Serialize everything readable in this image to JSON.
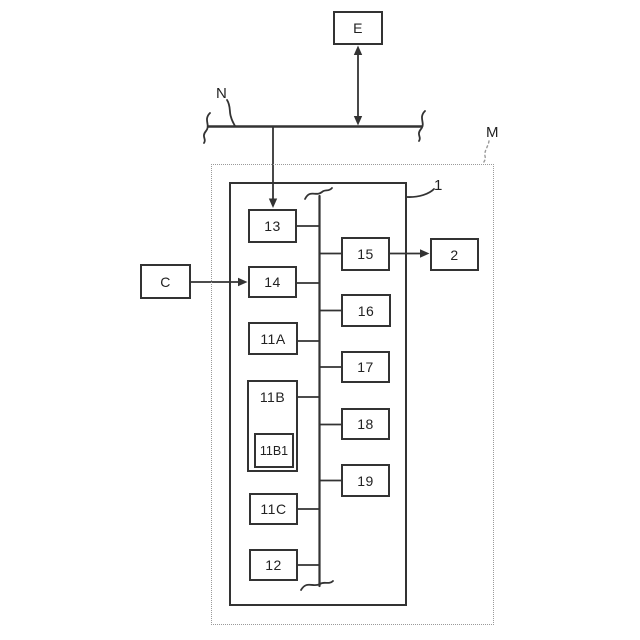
{
  "figure": {
    "type": "patent-block-diagram",
    "colors": {
      "line": "#333333",
      "boundary_dotted": "#9a9a9a",
      "background": "#ffffff",
      "text": "#222222"
    }
  },
  "boxes": {
    "e": "E",
    "c": "C",
    "two": "2",
    "b13": "13",
    "b14": "14",
    "b11a": "11A",
    "b11b": "11B",
    "b11b1": "11B1",
    "b11c": "11C",
    "b12": "12",
    "b15": "15",
    "b16": "16",
    "b17": "17",
    "b18": "18",
    "b19": "19"
  },
  "annotations": {
    "n": "N",
    "m": "M",
    "one": "1"
  },
  "connections": [
    "E <-> N (double-headed arrow)",
    "N -> 13 (arrow down)",
    "C -> 14 (arrow right)",
    "15 -> 2 (arrow right)",
    "internal bus links 13, 14, 11A, 11B, 11C, 12 with 15, 16, 17, 18, 19"
  ]
}
